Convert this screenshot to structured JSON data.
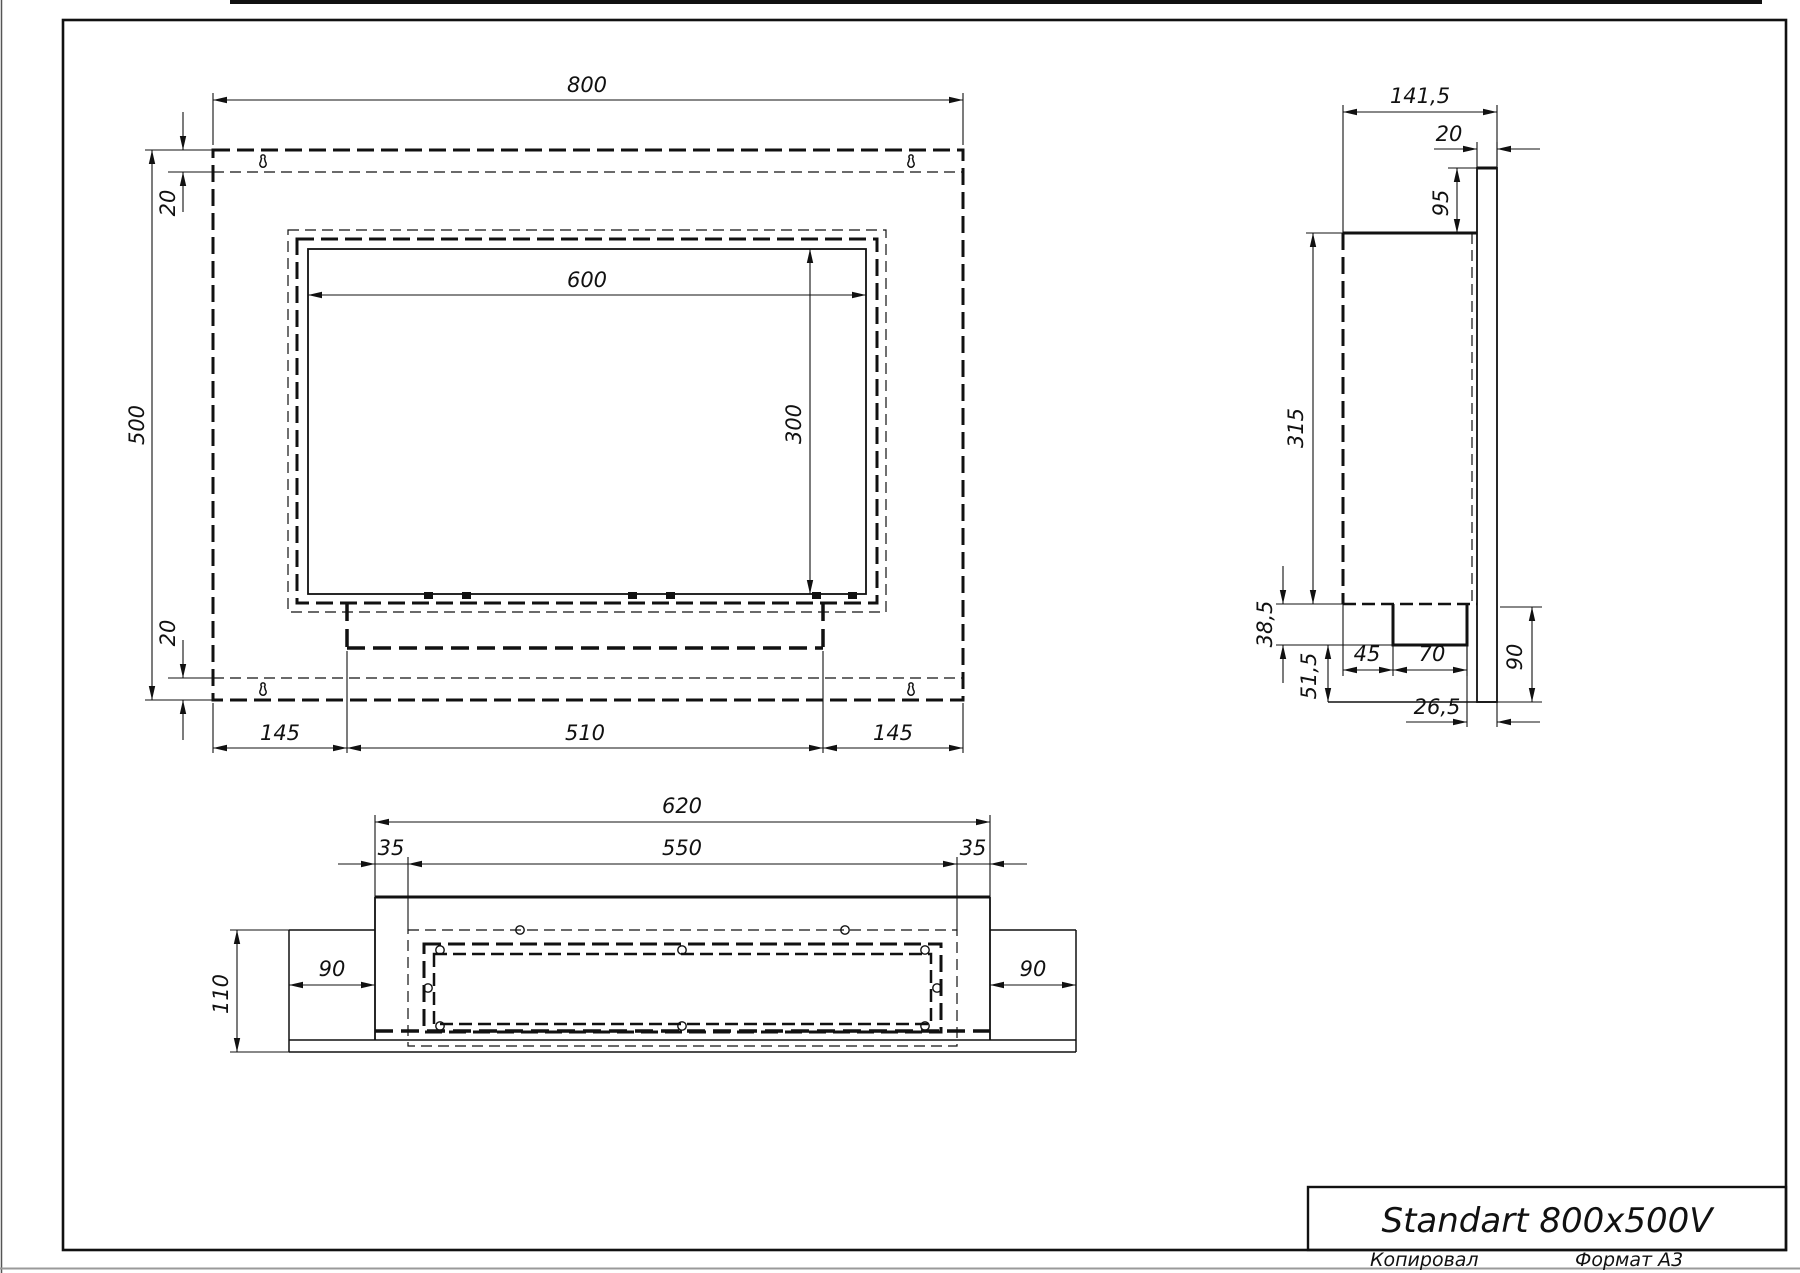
{
  "drawing": {
    "title_block": {
      "title": "Standart 800x500V"
    },
    "footer": {
      "copied_by": "Копировал",
      "format": "Формат А3"
    },
    "front_view": {
      "dim_800": "800",
      "dim_500": "500",
      "dim_20_top": "20",
      "dim_20_bottom": "20",
      "dim_600": "600",
      "dim_300": "300",
      "dim_145_left": "145",
      "dim_510": "510",
      "dim_145_right": "145"
    },
    "side_view": {
      "dim_141_5": "141,5",
      "dim_20": "20",
      "dim_95": "95",
      "dim_315": "315",
      "dim_38_5": "38,5",
      "dim_51_5": "51,5",
      "dim_45": "45",
      "dim_70": "70",
      "dim_90": "90",
      "dim_26_5": "26,5"
    },
    "bottom_view": {
      "dim_620": "620",
      "dim_35_left": "35",
      "dim_550": "550",
      "dim_35_right": "35",
      "dim_110": "110",
      "dim_90_left": "90",
      "dim_90_right": "90"
    }
  }
}
